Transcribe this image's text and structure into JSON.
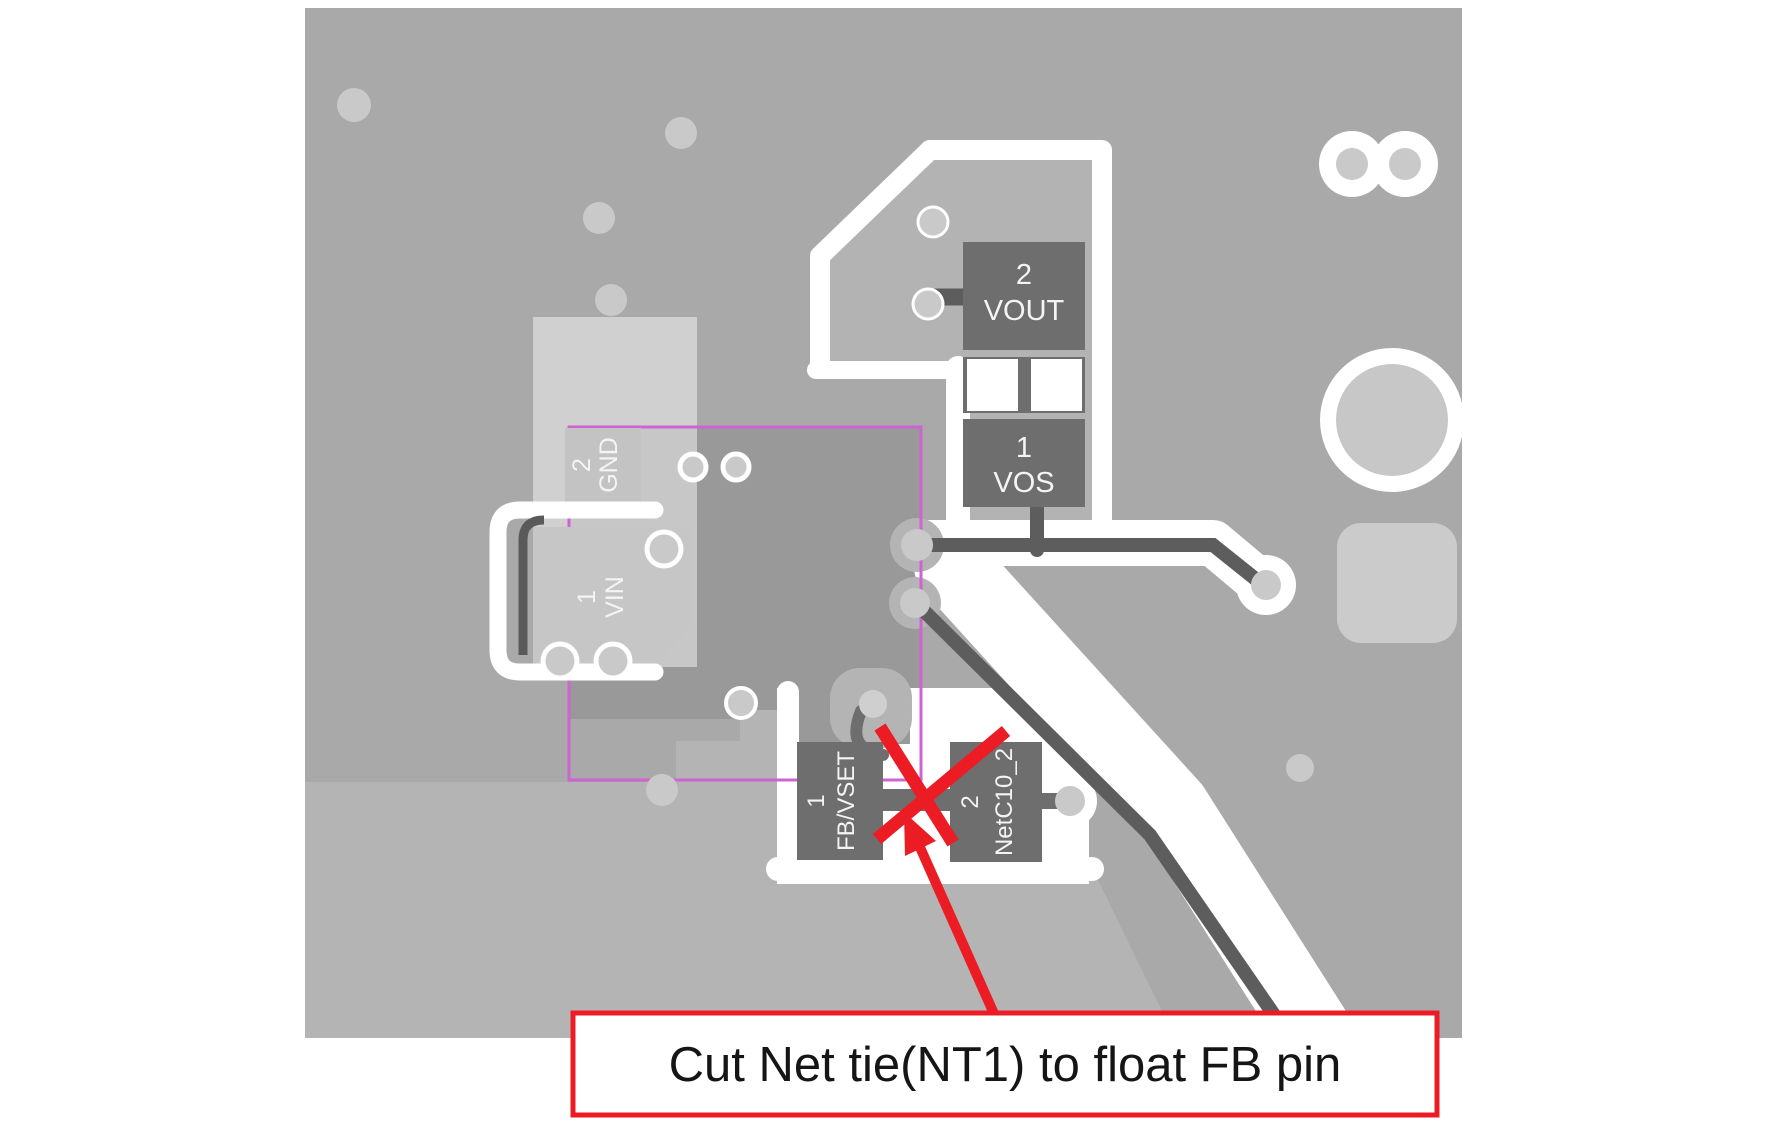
{
  "board": {
    "pads": {
      "vout": {
        "pin": "2",
        "net": "VOUT"
      },
      "vos": {
        "pin": "1",
        "net": "VOS"
      },
      "gnd": {
        "pin": "2",
        "net": "GND"
      },
      "vin": {
        "pin": "1",
        "net": "VIN"
      },
      "fb": {
        "pin": "1",
        "net": "FB/VSET"
      },
      "netc10": {
        "pin": "2",
        "net": "NetC10_2"
      }
    }
  },
  "colors": {
    "annotation_red": "#ec1c24",
    "courtyard_purple": "#cf63cf",
    "board_gray": "#a9a9a9",
    "dark_region_gray": "#999999",
    "pad_gray": "#6e6e6e",
    "via_gray": "#c9c9c9"
  },
  "callout": {
    "note": "Cut Net tie(NT1) to float FB pin"
  }
}
